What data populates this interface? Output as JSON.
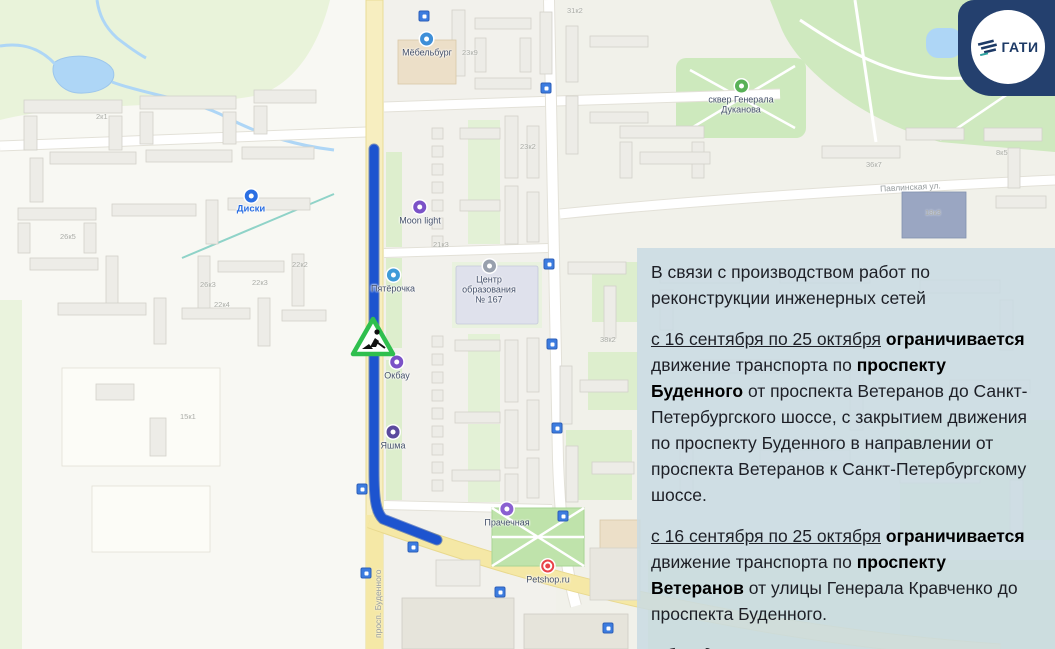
{
  "logo": {
    "text": "ГАТИ",
    "badge_color": "#24406e",
    "text_color": "#1d3a66"
  },
  "panel": {
    "bg_color": "rgba(201,219,227,0.85)",
    "paragraphs": [
      {
        "segments": [
          {
            "text": "В связи с производством работ по реконструкции инженерных сетей",
            "style": "normal"
          }
        ]
      },
      {
        "segments": [
          {
            "text": "с 16 сентября по 25 октября",
            "style": "underline"
          },
          {
            "text": " ",
            "style": "normal"
          },
          {
            "text": "ограничивается",
            "style": "bold"
          },
          {
            "text": " движение транспорта по ",
            "style": "normal"
          },
          {
            "text": "проспекту Буденного",
            "style": "bold"
          },
          {
            "text": " от проспекта Ветеранов до Санкт-Петербургского шоссе, с закрытием движения по проспекту Буденного в направлении от проспекта Ветеранов к Санкт-Петербургскому шоссе.",
            "style": "normal"
          }
        ]
      },
      {
        "segments": [
          {
            "text": "с 16 сентября по 25 октября",
            "style": "underline"
          },
          {
            "text": " ",
            "style": "normal"
          },
          {
            "text": "ограничивается",
            "style": "bold"
          },
          {
            "text": " движение транспорта по ",
            "style": "normal"
          },
          {
            "text": "проспекту Ветеранов",
            "style": "bold"
          },
          {
            "text": " от улицы Генерала Кравченко до проспекта Буденного.",
            "style": "normal"
          }
        ]
      },
      {
        "segments": [
          {
            "text": "Объезд: проспект Ветеранов.",
            "style": "italic"
          }
        ]
      }
    ]
  },
  "map": {
    "route_color": "#1d54cf",
    "road_color": "#f5e8a6",
    "water_color": "#aed6f6",
    "park_color": "#cfe9bf",
    "roadworks_sign_color": "#2fbf4e",
    "pois": [
      {
        "name": "Диски",
        "color": "#2b6fe3"
      },
      {
        "name": "Мёбельбург",
        "color": "#3e8fd8"
      },
      {
        "name": "Moon light",
        "color": "#7b52c7"
      },
      {
        "name": "Пятёрочка",
        "color": "#3f9bd8"
      },
      {
        "name": "Центр образования № 167",
        "color": "#98a0ad"
      },
      {
        "name": "Окбау",
        "color": "#7b52c7"
      },
      {
        "name": "Яшма",
        "color": "#5b4a9e"
      },
      {
        "name": "Прачечная",
        "color": "#8a5fd1"
      },
      {
        "name": "Petshop.ru",
        "color": "#e8434a"
      },
      {
        "name": "сквер Генерала Дуканова",
        "color": "#58b157"
      }
    ],
    "street_labels": [
      {
        "text": "просп. Буденного"
      },
      {
        "text": "Павлинская ул."
      }
    ],
    "building_labels": [
      "23к9",
      "31к2",
      "26к3",
      "22к2",
      "22к3",
      "22к4",
      "26к5",
      "2к1",
      "36к7",
      "18к3",
      "8к5",
      "23к2",
      "21к3",
      "15к1",
      "38к2"
    ]
  }
}
